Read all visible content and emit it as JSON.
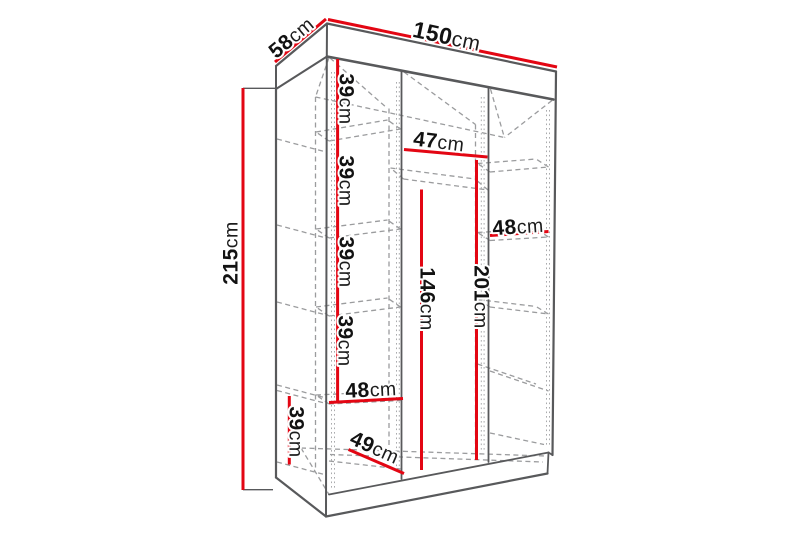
{
  "diagram": {
    "type": "wardrobe-dimension-diagram",
    "colors": {
      "background": "#ffffff",
      "accent": "#e30613",
      "outline": "#58595b",
      "dashed": "#9b9c9e",
      "text": "#121212"
    },
    "dims": {
      "depth": {
        "value": "58",
        "unit": "cm"
      },
      "width": {
        "value": "150",
        "unit": "cm"
      },
      "height": {
        "value": "215",
        "unit": "cm"
      },
      "shelf_gap_1": {
        "value": "39",
        "unit": "cm"
      },
      "shelf_gap_2": {
        "value": "39",
        "unit": "cm"
      },
      "shelf_gap_3": {
        "value": "39",
        "unit": "cm"
      },
      "shelf_gap_4": {
        "value": "39",
        "unit": "cm"
      },
      "left_width": {
        "value": "48",
        "unit": "cm"
      },
      "plinth_height": {
        "value": "39",
        "unit": "cm"
      },
      "floor_depth": {
        "value": "49",
        "unit": "cm"
      },
      "middle_width": {
        "value": "47",
        "unit": "cm"
      },
      "hanging_height": {
        "value": "146",
        "unit": "cm"
      },
      "right_height": {
        "value": "201",
        "unit": "cm"
      },
      "right_width": {
        "value": "48",
        "unit": "cm"
      }
    }
  }
}
